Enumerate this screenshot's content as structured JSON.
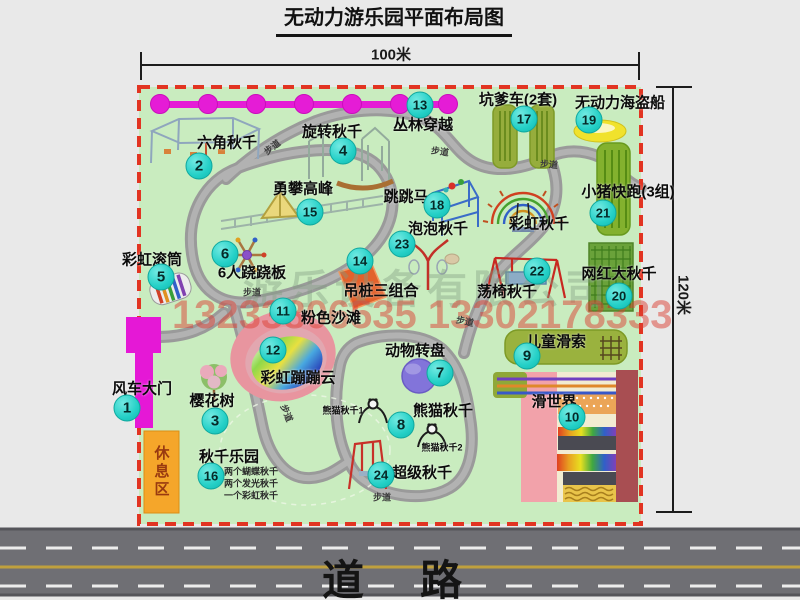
{
  "title": "无动力游乐园平面布局图",
  "dimension_labels": {
    "width": "100米",
    "height": "120米"
  },
  "road_label": "道路",
  "watermarks": {
    "company": "游乐设备有限公司",
    "phone": "13233806535 13302178333"
  },
  "rest_area_label": "休息区",
  "walkway_label": "步道",
  "colors": {
    "map_green": "#c9ecbf",
    "border_red": "#e23422",
    "badge_cyan": "#24d0c7",
    "gate_magenta": "#e518d6",
    "path_gray": "#a6a6a6",
    "road_gray": "#6f6f74",
    "rest_orange": "#f5a62a",
    "watermark_red": "#db4034"
  },
  "attractions": [
    {
      "id": 1,
      "label": "风车大门",
      "badge": [
        127,
        408
      ],
      "label_pos": [
        142,
        388
      ]
    },
    {
      "id": 2,
      "label": "六角秋千",
      "badge": [
        199,
        166
      ],
      "label_pos": [
        227,
        142
      ]
    },
    {
      "id": 3,
      "label": "樱花树",
      "badge": [
        215,
        421
      ],
      "label_pos": [
        212,
        400
      ]
    },
    {
      "id": 4,
      "label": "旋转秋千",
      "badge": [
        343,
        151
      ],
      "label_pos": [
        332,
        131
      ]
    },
    {
      "id": 5,
      "label": "彩虹滚筒",
      "badge": [
        161,
        277
      ],
      "label_pos": [
        152,
        259
      ]
    },
    {
      "id": 6,
      "label": "6人跷跷板",
      "badge": [
        225,
        254
      ],
      "label_pos": [
        252,
        272
      ]
    },
    {
      "id": 7,
      "label": "动物转盘",
      "badge": [
        440,
        373
      ],
      "label_pos": [
        415,
        350
      ]
    },
    {
      "id": 8,
      "label": "熊猫秋千",
      "badge": [
        401,
        425
      ],
      "label_pos": [
        443,
        410
      ]
    },
    {
      "id": 9,
      "label": "儿童滑索",
      "badge": [
        527,
        356
      ],
      "label_pos": [
        556,
        341
      ]
    },
    {
      "id": 10,
      "label": "滑世界",
      "badge": [
        572,
        417
      ],
      "label_pos": [
        554,
        401
      ]
    },
    {
      "id": 11,
      "label": "粉色沙滩",
      "badge": [
        283,
        311
      ],
      "label_pos": [
        331,
        317
      ]
    },
    {
      "id": 12,
      "label": "彩虹蹦蹦云",
      "badge": [
        273,
        350
      ],
      "label_pos": [
        298,
        377
      ]
    },
    {
      "id": 13,
      "label": "丛林穿越",
      "badge": [
        420,
        105
      ],
      "label_pos": [
        423,
        124
      ]
    },
    {
      "id": 14,
      "label": "吊桩三组合",
      "badge": [
        360,
        261
      ],
      "label_pos": [
        381,
        290
      ]
    },
    {
      "id": 15,
      "label": "勇攀高峰",
      "badge": [
        310,
        212
      ],
      "label_pos": [
        303,
        188
      ]
    },
    {
      "id": 16,
      "label": "秋千乐园",
      "badge": [
        211,
        476
      ],
      "label_pos": [
        229,
        456
      ],
      "notes": [
        "两个蝴蝶秋千",
        "两个发光秋千",
        "一个彩虹秋千"
      ],
      "notes_pos": {
        "x": 224,
        "y": 471,
        "dy": 12
      }
    },
    {
      "id": 17,
      "label": "坑爹车(2套)",
      "badge": [
        524,
        119
      ],
      "label_pos": [
        518,
        99
      ]
    },
    {
      "id": 18,
      "label": "跳跳马",
      "badge": [
        437,
        205
      ],
      "label_pos": [
        406,
        196
      ]
    },
    {
      "id": 19,
      "label": "无动力海盗船",
      "badge": [
        589,
        120
      ],
      "label_pos": [
        620,
        102
      ]
    },
    {
      "id": 20,
      "label": "网红大秋千",
      "badge": [
        619,
        296
      ],
      "label_pos": [
        619,
        273
      ]
    },
    {
      "id": 21,
      "label": "小猪快跑(3组)",
      "badge": [
        603,
        213
      ],
      "label_pos": [
        628,
        191
      ]
    },
    {
      "id": 22,
      "label": "荡椅秋千",
      "badge": [
        537,
        271
      ],
      "label_pos": [
        507,
        291
      ]
    },
    {
      "id": 23,
      "label": "泡泡秋千",
      "badge": [
        402,
        244
      ],
      "label_pos": [
        438,
        228
      ]
    },
    {
      "id": 24,
      "label": "超级秋千",
      "badge": [
        381,
        475
      ],
      "label_pos": [
        422,
        472
      ]
    }
  ],
  "extra_labels": [
    {
      "text": "彩虹秋千",
      "x": 539,
      "y": 223,
      "size": 15
    },
    {
      "text": "熊猫秋千1",
      "x": 343,
      "y": 410,
      "size": 9
    },
    {
      "text": "熊猫秋千2",
      "x": 442,
      "y": 447,
      "size": 9
    }
  ],
  "walkways": [
    {
      "x": 272,
      "y": 147,
      "rot": -38
    },
    {
      "x": 440,
      "y": 151,
      "rot": 8
    },
    {
      "x": 549,
      "y": 164,
      "rot": 5
    },
    {
      "x": 252,
      "y": 292,
      "rot": 0
    },
    {
      "x": 465,
      "y": 321,
      "rot": 12
    },
    {
      "x": 287,
      "y": 413,
      "rot": 68
    },
    {
      "x": 382,
      "y": 497,
      "rot": 0
    }
  ]
}
